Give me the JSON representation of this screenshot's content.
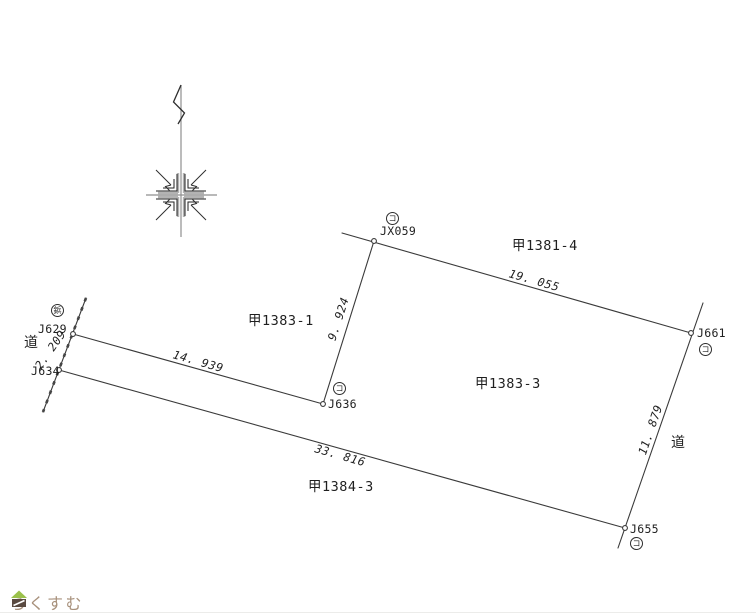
{
  "parcels": {
    "p1381_4": "甲1381-4",
    "p1383_1": "甲1383-1",
    "p1383_3": "甲1383-3",
    "p1384_3": "甲1384-3"
  },
  "roads": {
    "left": "道",
    "right": "道"
  },
  "points": {
    "jx059": {
      "label": "JX059",
      "symbol": "コ"
    },
    "j629": {
      "label": "J629",
      "symbol": "鋲"
    },
    "j634": {
      "label": "J634"
    },
    "j636": {
      "label": "J636",
      "symbol": "コ"
    },
    "j661": {
      "label": "J661",
      "symbol": "コ"
    },
    "j655": {
      "label": "J655",
      "symbol": "コ"
    }
  },
  "measurements": {
    "m19055": {
      "from": "JX059",
      "to": "J661",
      "value": "19. 055"
    },
    "m9924": {
      "from": "JX059",
      "to": "J636",
      "value": "9. 924"
    },
    "m14939": {
      "from": "J629",
      "to": "J636",
      "value": "14. 939"
    },
    "m2209": {
      "from": "J629",
      "to": "J634",
      "value": "2. 209"
    },
    "m33816": {
      "from": "J634",
      "to": "J655",
      "value": "33. 816"
    },
    "m11879": {
      "from": "J661",
      "to": "J655",
      "value": "11. 879"
    }
  },
  "footer": {
    "brand": "らくすむ"
  },
  "colors": {
    "line": "#3a3a3a",
    "north_gray": "#8f8f8f",
    "brand_text": "#a8917c",
    "brand_green": "#9bc14b",
    "brand_brown": "#5a4a40"
  }
}
